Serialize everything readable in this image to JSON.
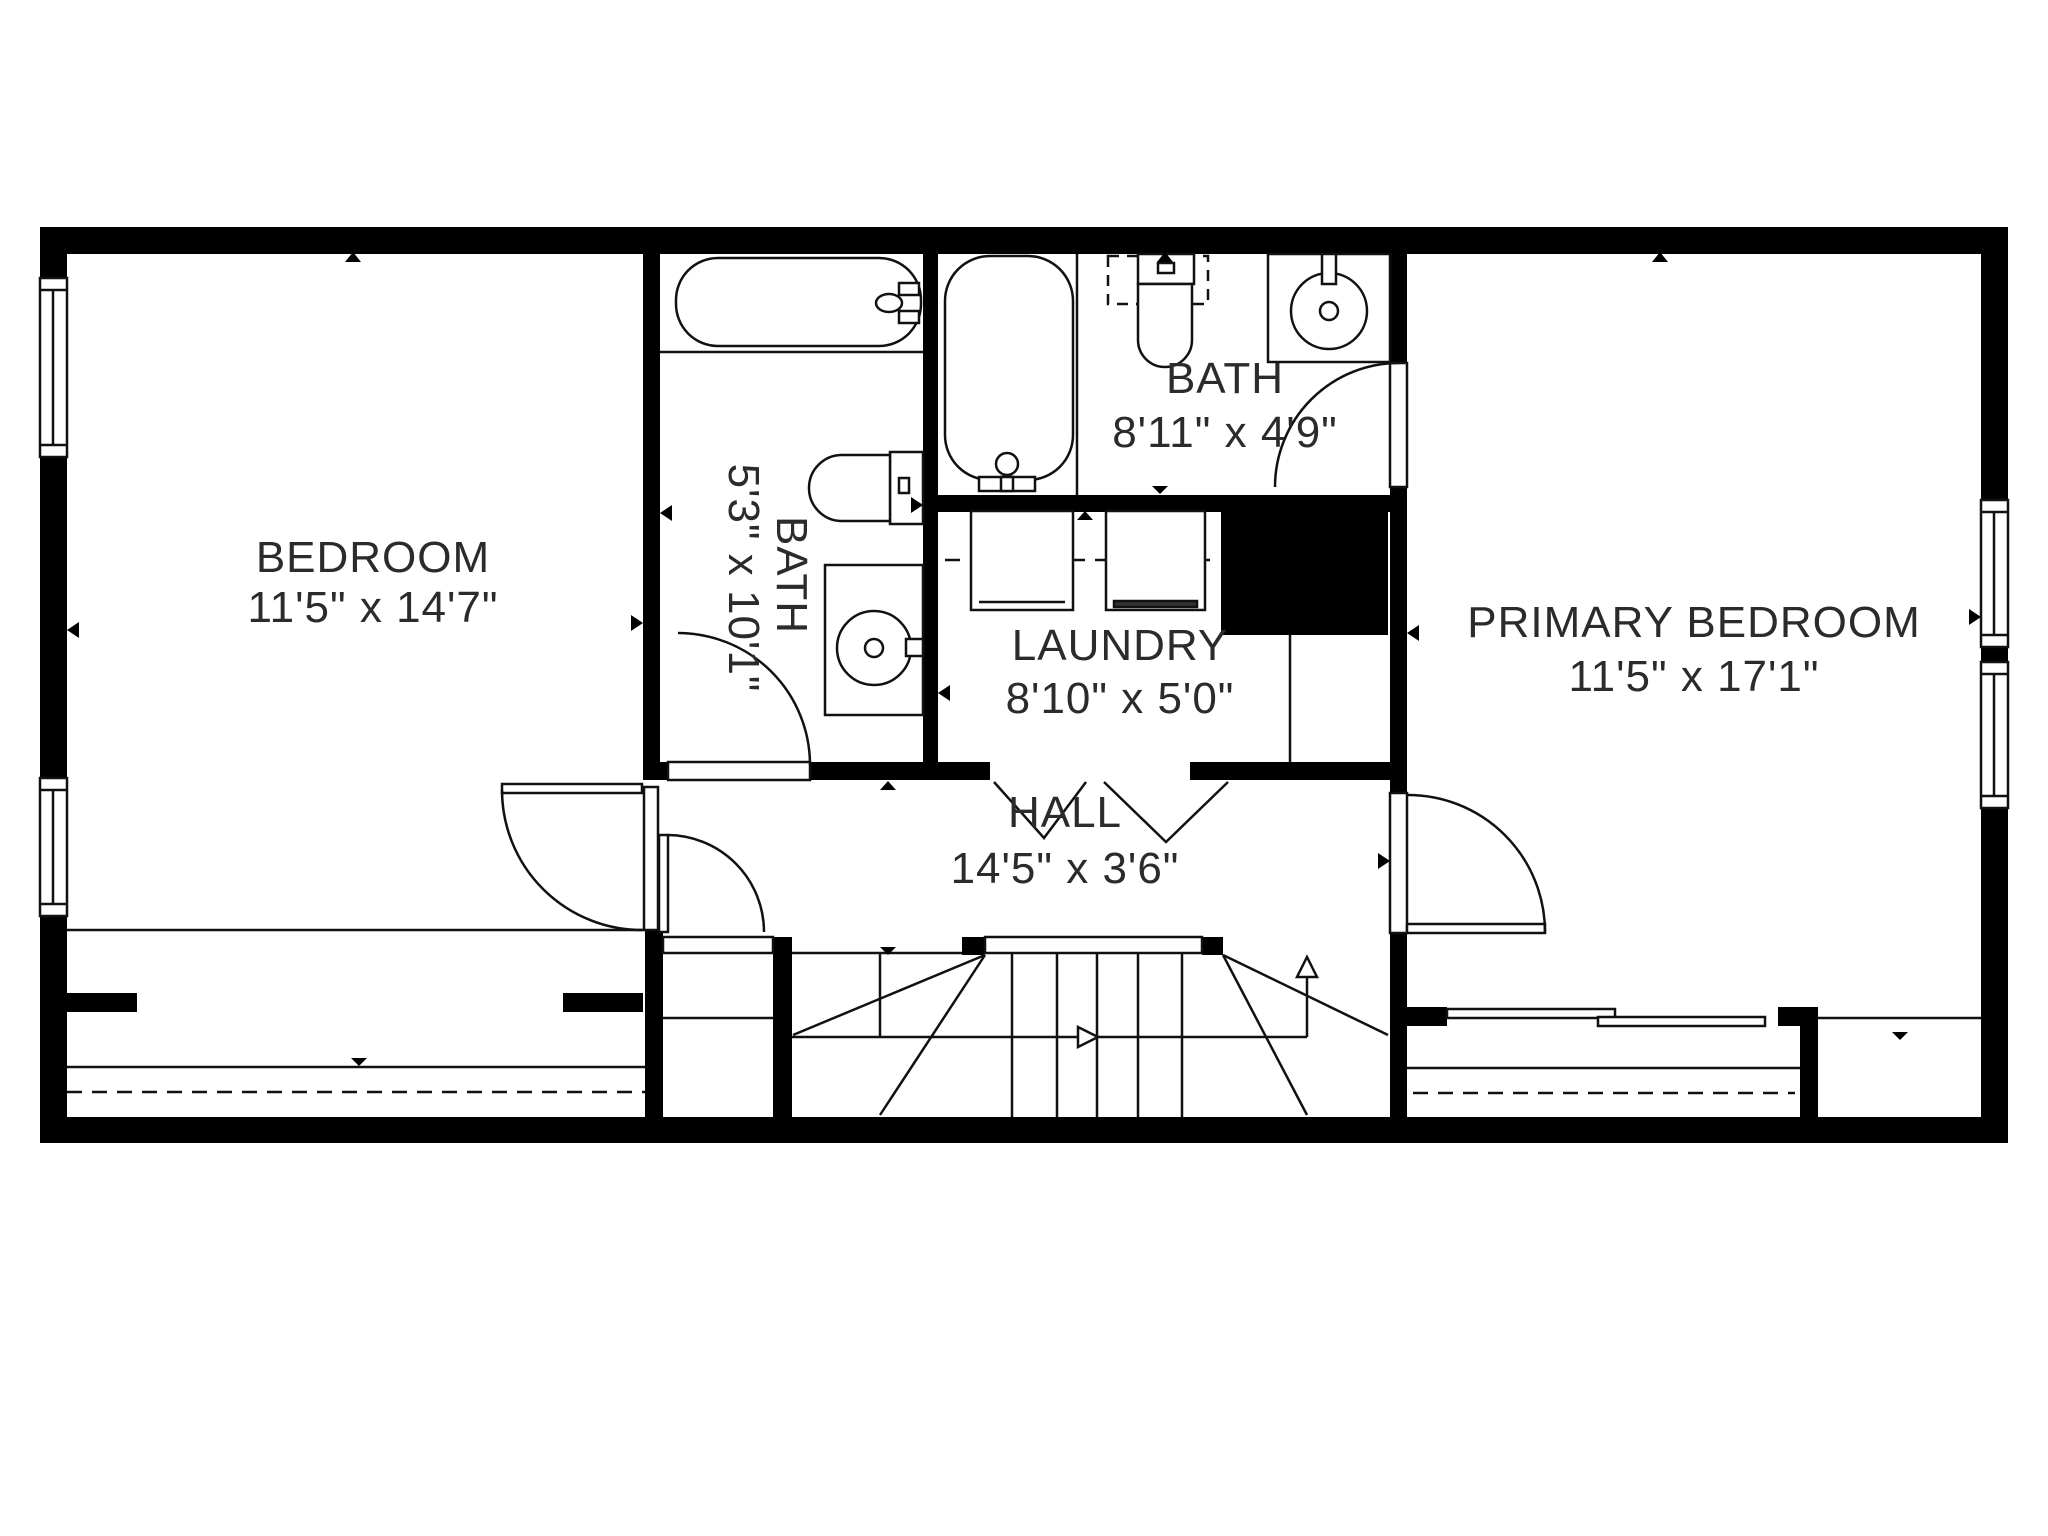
{
  "plan": {
    "type": "floor-plan",
    "colors": {
      "wall": "#000000",
      "line": "#111111",
      "text": "#2b2b2b",
      "background": "#ffffff"
    },
    "rooms": {
      "bedroom": {
        "name": "BEDROOM",
        "dims": "11'5\" x 14'7\""
      },
      "bath_main": {
        "name": "BATH",
        "dims": "5'3\" x 10'1\""
      },
      "bath_top": {
        "name": "BATH",
        "dims": "8'11\" x 4'9\""
      },
      "laundry": {
        "name": "LAUNDRY",
        "dims": "8'10\" x 5'0\""
      },
      "hall": {
        "name": "HALL",
        "dims": "14'5\" x 3'6\""
      },
      "primary_bedroom": {
        "name": "PRIMARY BEDROOM",
        "dims": "11'5\" x 17'1\""
      }
    },
    "icons": [
      "bathtub-icon",
      "toilet-icon",
      "sink-icon",
      "washer-icon",
      "dryer-icon",
      "stairs-up-icon",
      "door-swing-icon",
      "window-icon",
      "wall-marker-icon",
      "closet-slider-icon"
    ]
  }
}
